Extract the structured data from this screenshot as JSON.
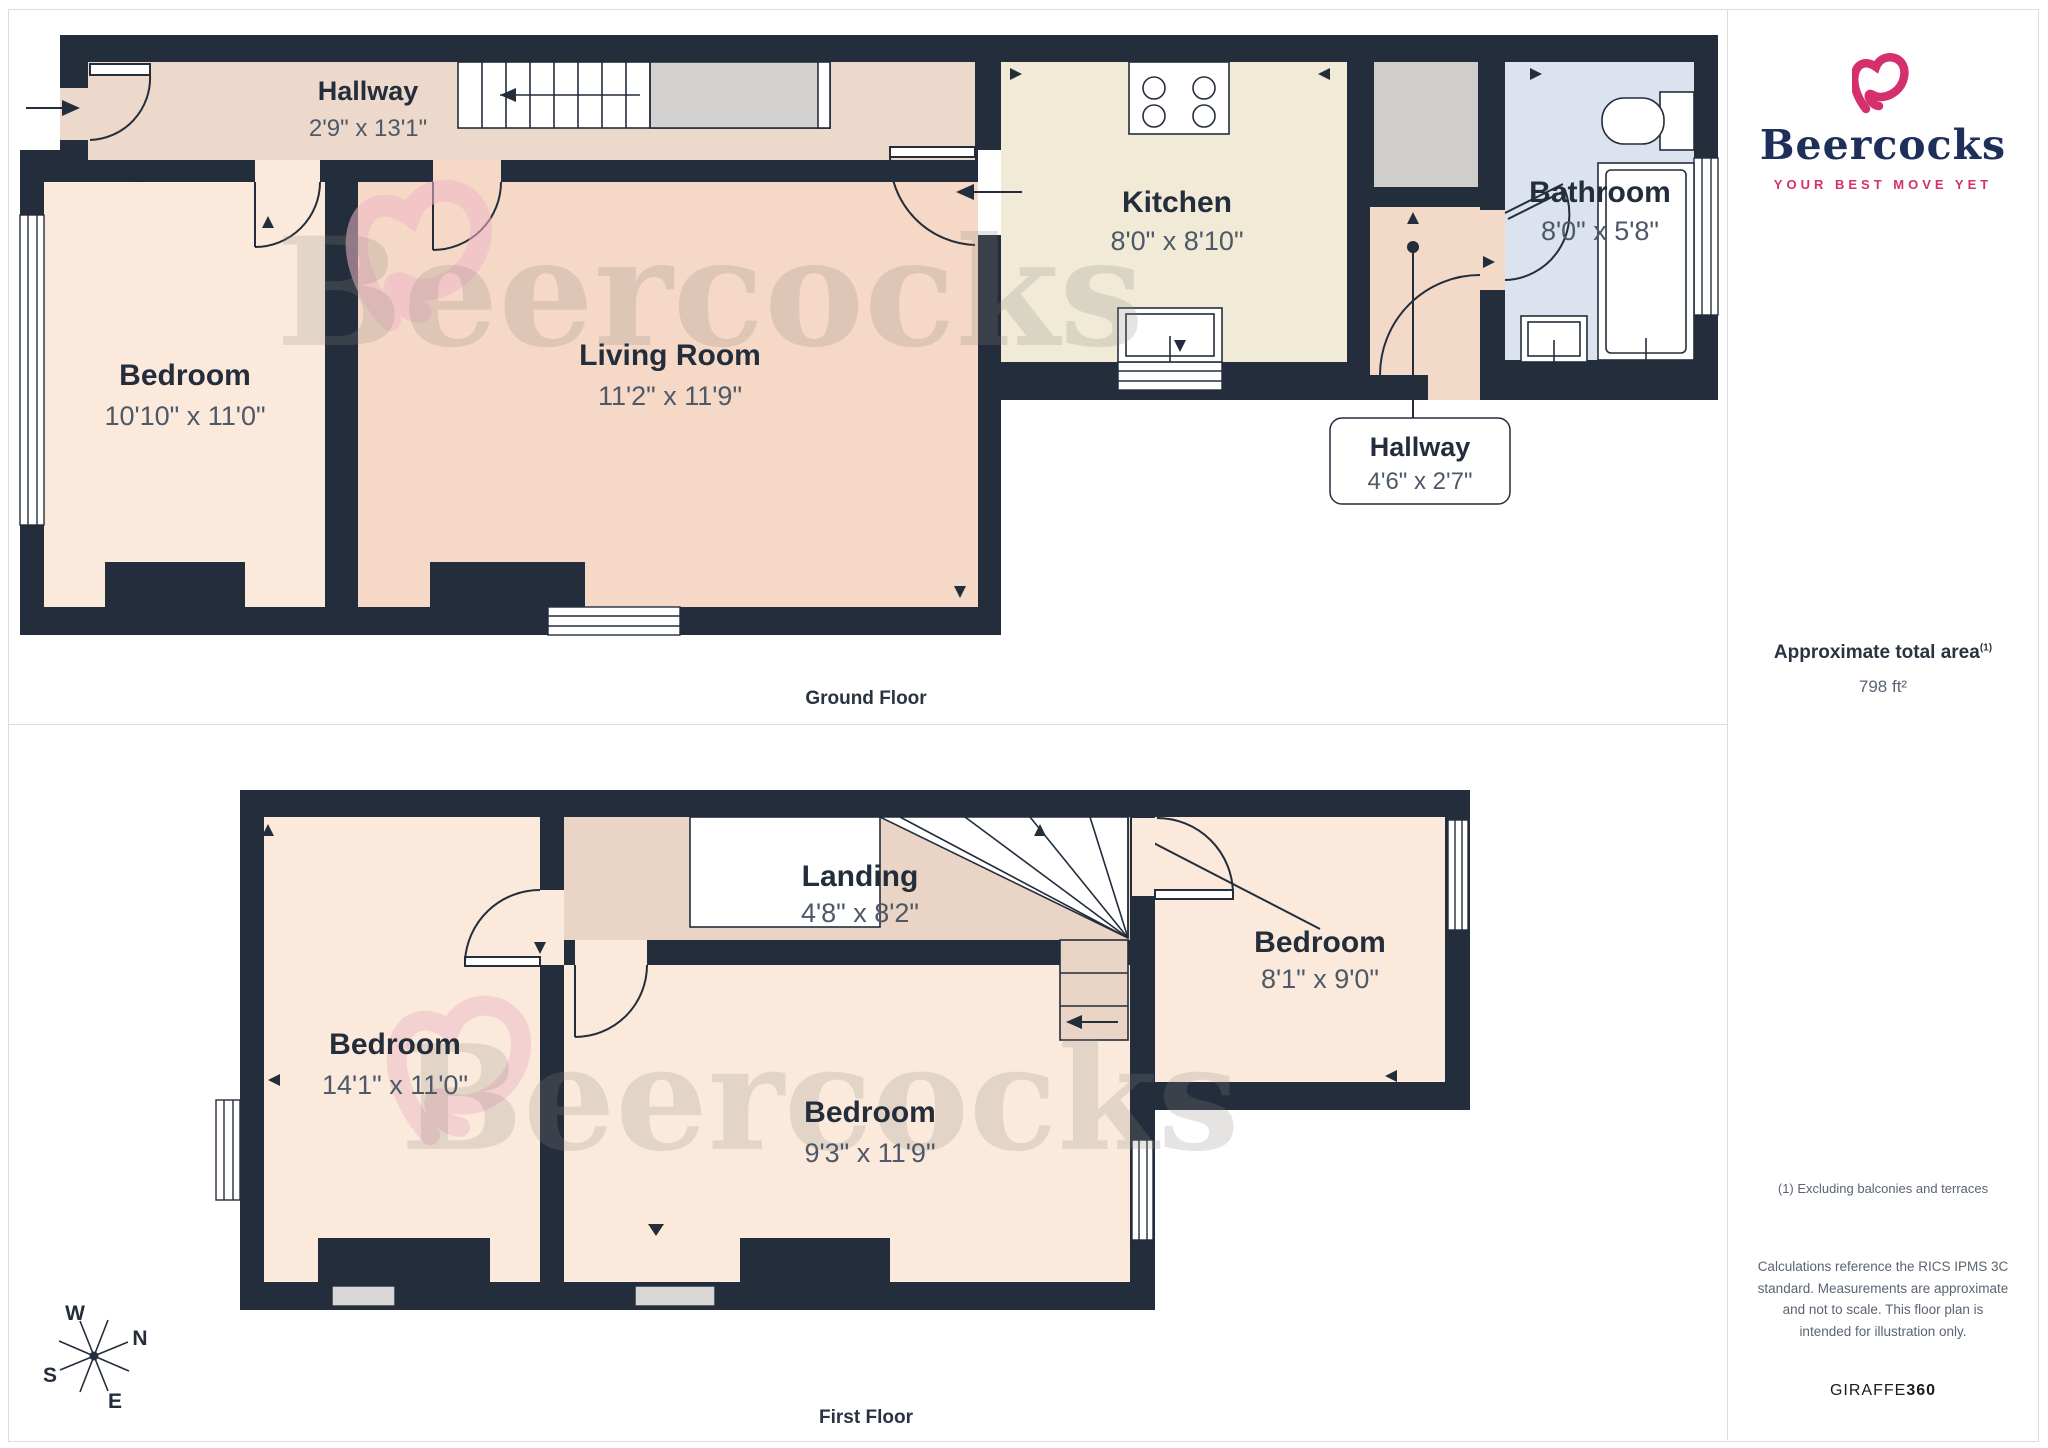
{
  "branding": {
    "wordmark": "Beercocks",
    "tagline": "YOUR BEST MOVE YET",
    "watermark": "Beercocks",
    "footer_brand": "GIRAFFE",
    "footer_brand_bold": "360"
  },
  "sidebar": {
    "area_title": "Approximate total area",
    "area_note_ref": "(1)",
    "area_value": "798 ft²",
    "footnote": "(1) Excluding balconies and terraces",
    "disclaimer": "Calculations reference the RICS IPMS 3C standard. Measurements are approximate and not to scale. This floor plan is intended for illustration only."
  },
  "floors": {
    "ground": {
      "label": "Ground Floor",
      "hallway": {
        "name": "Hallway",
        "dims": "2'9\" x 13'1\""
      },
      "bedroom": {
        "name": "Bedroom",
        "dims": "10'10\" x 11'0\""
      },
      "living": {
        "name": "Living Room",
        "dims": "11'2\" x 11'9\""
      },
      "kitchen": {
        "name": "Kitchen",
        "dims": "8'0\" x 8'10\""
      },
      "rear_hallway": {
        "name": "Hallway",
        "dims": "4'6\" x 2'7\""
      },
      "bathroom": {
        "name": "Bathroom",
        "dims": "8'0\" x 5'8\""
      }
    },
    "first": {
      "label": "First Floor",
      "bedroom_front": {
        "name": "Bedroom",
        "dims": "14'1\" x 11'0\""
      },
      "landing": {
        "name": "Landing",
        "dims": "4'8\" x 8'2\""
      },
      "bedroom_middle": {
        "name": "Bedroom",
        "dims": "9'3\" x 11'9\""
      },
      "bedroom_rear": {
        "name": "Bedroom",
        "dims": "8'1\" x 9'0\""
      }
    }
  },
  "compass": {
    "n": "N",
    "e": "E",
    "s": "S",
    "w": "W"
  },
  "colors": {
    "wall": "#232d3b",
    "hallway_tan": "#ecd9cb",
    "bedroom_peach": "#fbeadc",
    "living_pink": "#f5d9c6",
    "kitchen_cream": "#f0ead7",
    "bathroom_blue": "#dce3ee",
    "stairs_grey": "#d4d2d0",
    "brand_pink": "#d62f6d",
    "brand_navy": "#1e2f5a"
  }
}
